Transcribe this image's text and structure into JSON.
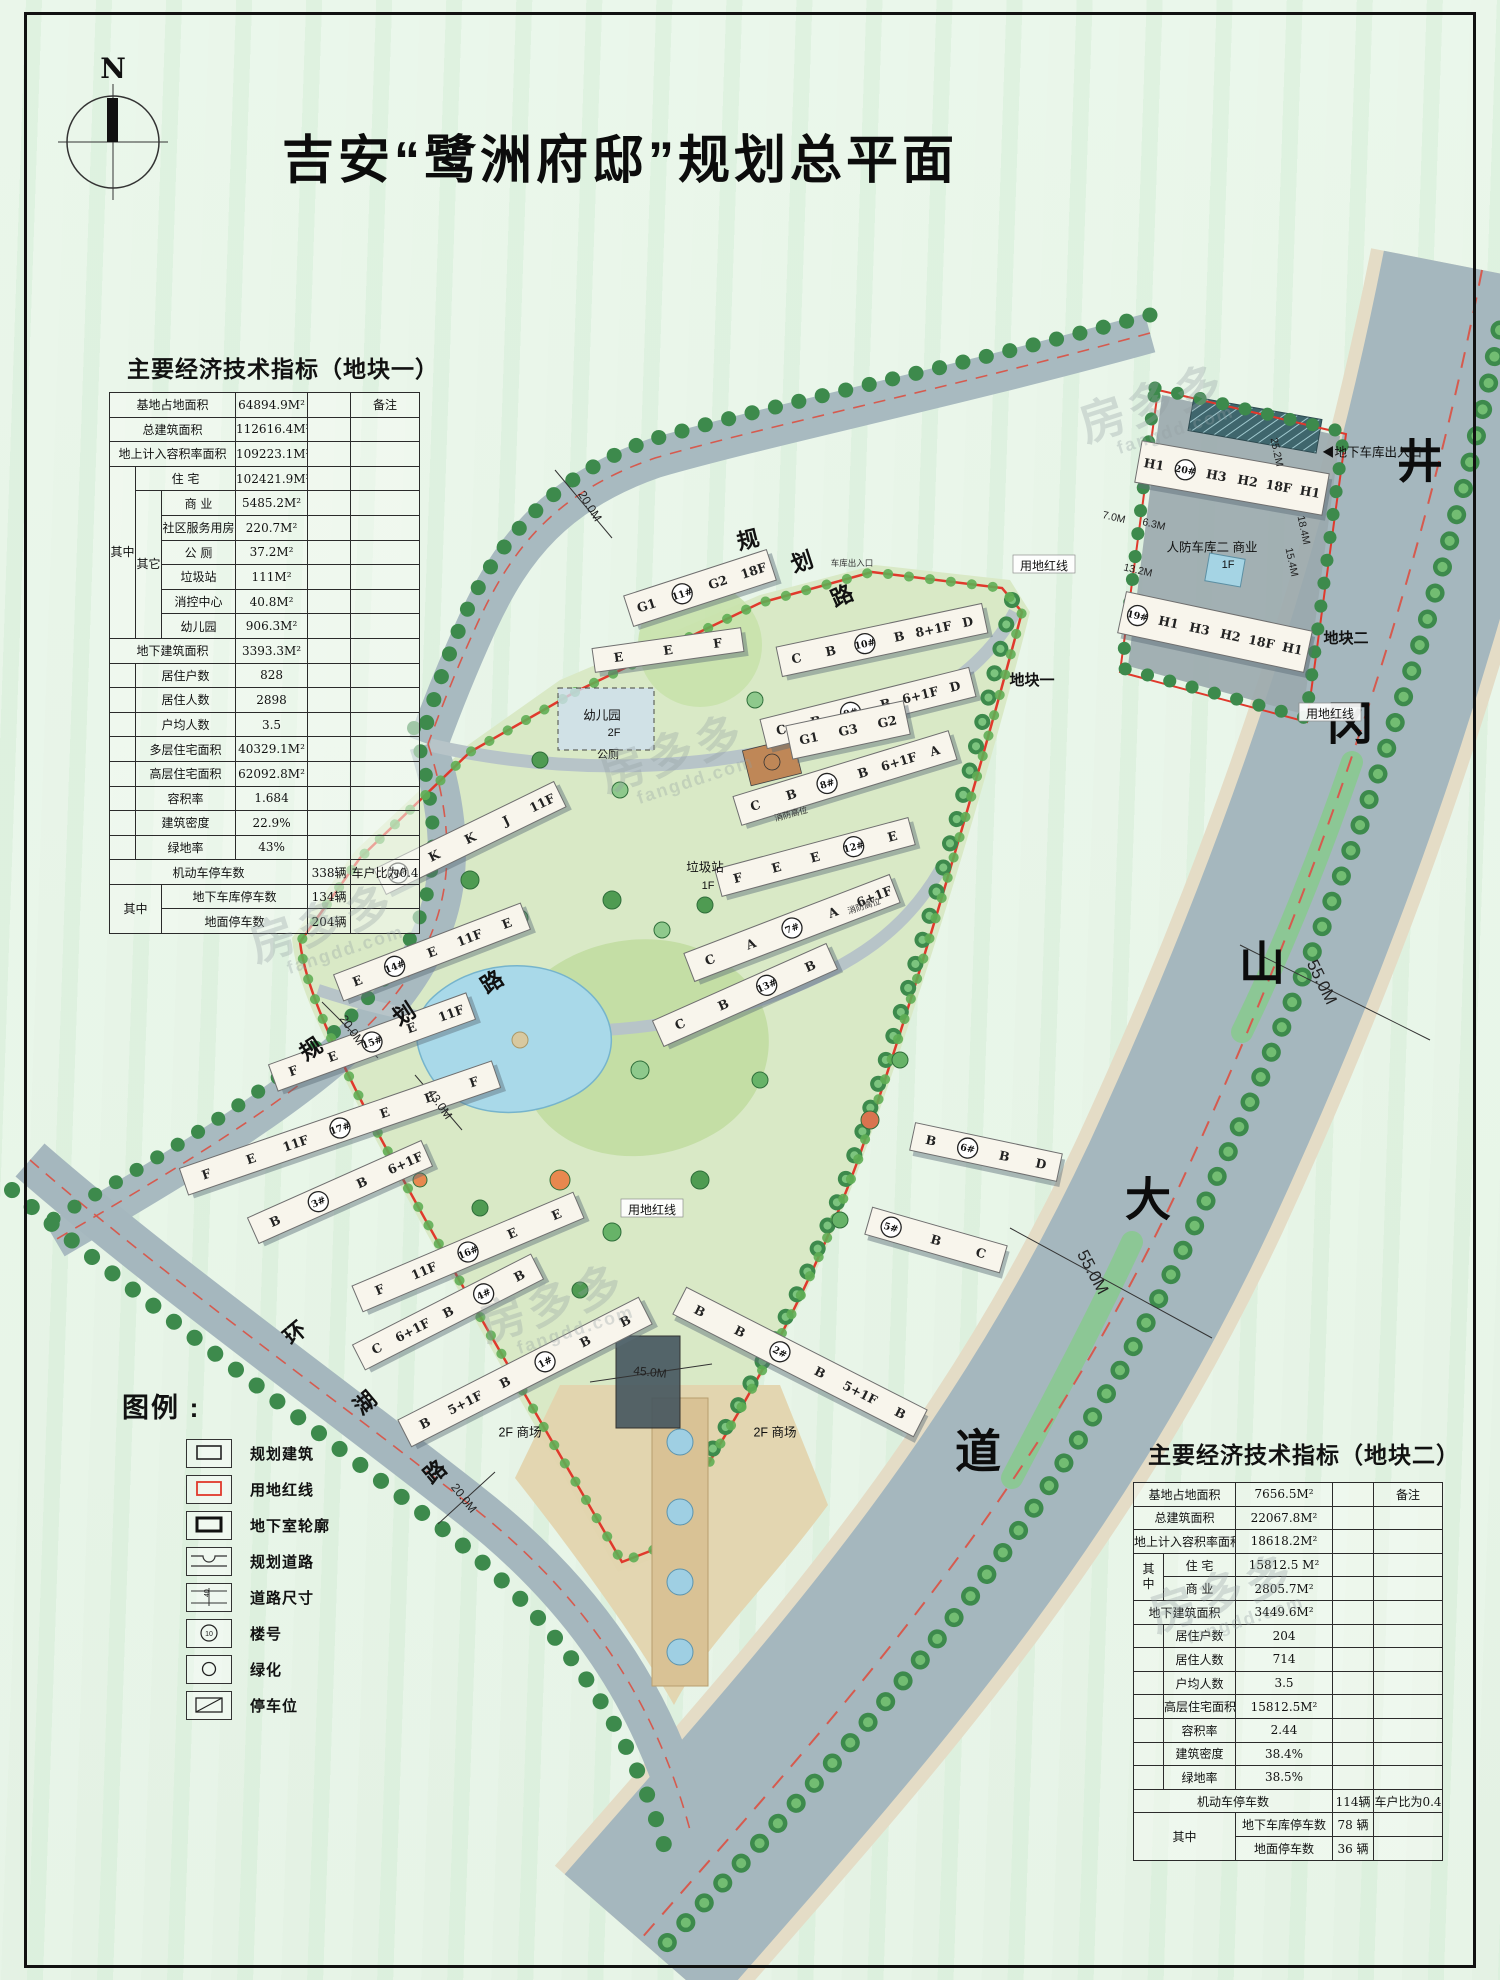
{
  "page": {
    "title": "吉安“鹭洲府邸”规划总平面",
    "north_label": "N"
  },
  "table1": {
    "title": "主要经济技术指标（地块一）",
    "remark_header": "备注",
    "qizhong": "其中",
    "qita": "其它",
    "qizhong2": "其中",
    "r1": {
      "label": "基地占地面积",
      "value": "64894.9M²"
    },
    "r2": {
      "label": "总建筑面积",
      "value": "112616.4M²"
    },
    "r3": {
      "label": "地上计入容积率面积",
      "value": "109223.1M²"
    },
    "r4": {
      "label": "住 宅",
      "value": "102421.9M²"
    },
    "r5": {
      "label": "商 业",
      "value": "5485.2M²"
    },
    "r6": {
      "label": "社区服务用房",
      "value": "220.7M²"
    },
    "r7": {
      "label": "公 厕",
      "value": "37.2M²"
    },
    "r8": {
      "label": "垃圾站",
      "value": "111M²"
    },
    "r9": {
      "label": "消控中心",
      "value": "40.8M²"
    },
    "r10": {
      "label": "幼儿园",
      "value": "906.3M²"
    },
    "r11": {
      "label": "地下建筑面积",
      "value": "3393.3M²"
    },
    "r12": {
      "label": "居住户数",
      "value": "828"
    },
    "r13": {
      "label": "居住人数",
      "value": "2898"
    },
    "r14": {
      "label": "户均人数",
      "value": "3.5"
    },
    "r15": {
      "label": "多层住宅面积",
      "value": "40329.1M²"
    },
    "r16": {
      "label": "高层住宅面积",
      "value": "62092.8M²"
    },
    "r17": {
      "label": "容积率",
      "value": "1.684"
    },
    "r18": {
      "label": "建筑密度",
      "value": "22.9%"
    },
    "r19": {
      "label": "绿地率",
      "value": "43%"
    },
    "r20": {
      "label": "机动车停车数",
      "value": "338辆",
      "remark": "车户比为0.4"
    },
    "r21": {
      "label": "地下车库停车数",
      "value": "134辆"
    },
    "r22": {
      "label": "地面停车数",
      "value": "204辆"
    }
  },
  "table2": {
    "title": "主要经济技术指标（地块二）",
    "remark_header": "备注",
    "qizhong": "其\n中",
    "qizhong2": "其中",
    "r1": {
      "label": "基地占地面积",
      "value": "7656.5M²"
    },
    "r2": {
      "label": "总建筑面积",
      "value": "22067.8M²"
    },
    "r3": {
      "label": "地上计入容积率面积",
      "value": "18618.2M²"
    },
    "r4": {
      "label": "住 宅",
      "value": "15812.5 M²"
    },
    "r5": {
      "label": "商 业",
      "value": "2805.7M²"
    },
    "r6": {
      "label": "地下建筑面积",
      "value": "3449.6M²"
    },
    "r7": {
      "label": "居住户数",
      "value": "204"
    },
    "r8": {
      "label": "居住人数",
      "value": "714"
    },
    "r9": {
      "label": "户均人数",
      "value": "3.5"
    },
    "r10": {
      "label": "高层住宅面积",
      "value": "15812.5M²"
    },
    "r11": {
      "label": "容积率",
      "value": "2.44"
    },
    "r12": {
      "label": "建筑密度",
      "value": "38.4%"
    },
    "r13": {
      "label": "绿地率",
      "value": "38.5%"
    },
    "r14": {
      "label": "机动车停车数",
      "value": "114辆",
      "remark": "车户比为0.4"
    },
    "r15": {
      "label": "地下车库停车数",
      "value": "78 辆"
    },
    "r16": {
      "label": "地面停车数",
      "value": "36 辆"
    }
  },
  "legend": {
    "title": "图例 :",
    "items": [
      {
        "label": "规划建筑"
      },
      {
        "label": "用地红线"
      },
      {
        "label": "地下室轮廓"
      },
      {
        "label": "规划道路"
      },
      {
        "label": "道路尺寸",
        "symbol_text": "40"
      },
      {
        "label": "楼号",
        "symbol_text": "10"
      },
      {
        "label": "绿化"
      },
      {
        "label": "停车位"
      }
    ]
  },
  "watermark": {
    "brand": "房多多",
    "domain": "fangdd.com",
    "positions": [
      {
        "x": 1080,
        "y": 380
      },
      {
        "x": 600,
        "y": 730
      },
      {
        "x": 480,
        "y": 1280
      },
      {
        "x": 1150,
        "y": 1570
      },
      {
        "x": 250,
        "y": 900
      }
    ]
  },
  "map": {
    "colors": {
      "road": "#a5b7be",
      "site": "#d9e9c6",
      "red_line": "#e0392c",
      "water": "#a9d9e9",
      "median": "#8cc795"
    },
    "labels": [
      {
        "t": "井",
        "x": 1420,
        "y": 462,
        "r": 0,
        "c": "ave"
      },
      {
        "t": "冈",
        "x": 1350,
        "y": 724,
        "r": 0,
        "c": "ave"
      },
      {
        "t": "山",
        "x": 1262,
        "y": 964,
        "r": 0,
        "c": "ave"
      },
      {
        "t": "大",
        "x": 1148,
        "y": 1200,
        "r": 0,
        "c": "ave"
      },
      {
        "t": "道",
        "x": 978,
        "y": 1452,
        "r": 0,
        "c": "ave"
      },
      {
        "t": "规",
        "x": 748,
        "y": 540,
        "r": -14,
        "c": "road"
      },
      {
        "t": "划",
        "x": 802,
        "y": 562,
        "r": -18,
        "c": "road"
      },
      {
        "t": "路",
        "x": 842,
        "y": 596,
        "r": -24,
        "c": "road"
      },
      {
        "t": "20.0M",
        "x": 590,
        "y": 506,
        "r": 58,
        "c": "dim"
      },
      {
        "t": "规",
        "x": 311,
        "y": 1049,
        "r": -33,
        "c": "road"
      },
      {
        "t": "划",
        "x": 404,
        "y": 1014,
        "r": -33,
        "c": "road"
      },
      {
        "t": "路",
        "x": 492,
        "y": 982,
        "r": -33,
        "c": "road"
      },
      {
        "t": "20.0M",
        "x": 352,
        "y": 1030,
        "r": 55,
        "c": "dim"
      },
      {
        "t": "环",
        "x": 295,
        "y": 1333,
        "r": -40,
        "c": "road"
      },
      {
        "t": "湖",
        "x": 365,
        "y": 1403,
        "r": -40,
        "c": "road"
      },
      {
        "t": "路",
        "x": 435,
        "y": 1472,
        "r": -40,
        "c": "road"
      },
      {
        "t": "20.0M",
        "x": 464,
        "y": 1498,
        "r": 52,
        "c": "dim"
      },
      {
        "t": "55.0M",
        "x": 1093,
        "y": 1272,
        "r": 62,
        "c": "dim-lg"
      },
      {
        "t": "55.0M",
        "x": 1322,
        "y": 982,
        "r": 64,
        "c": "dim-lg"
      },
      {
        "t": "45.0M",
        "x": 650,
        "y": 1372,
        "r": 6,
        "c": "dim"
      },
      {
        "t": "43.0M",
        "x": 440,
        "y": 1104,
        "r": 55,
        "c": "dim"
      },
      {
        "t": "7.0M",
        "x": 1114,
        "y": 517,
        "r": 13,
        "c": "dim-s"
      },
      {
        "t": "6.3M",
        "x": 1154,
        "y": 524,
        "r": 13,
        "c": "dim-s"
      },
      {
        "t": "13.2M",
        "x": 1138,
        "y": 570,
        "r": 13,
        "c": "dim-s"
      },
      {
        "t": "25.2M",
        "x": 1277,
        "y": 452,
        "r": 78,
        "c": "dim-s"
      },
      {
        "t": "18.4M",
        "x": 1304,
        "y": 530,
        "r": 78,
        "c": "dim-s"
      },
      {
        "t": "15.4M",
        "x": 1292,
        "y": 562,
        "r": 78,
        "c": "dim-s"
      },
      {
        "t": "地块一",
        "x": 1032,
        "y": 680,
        "r": 0,
        "c": "note-lg"
      },
      {
        "t": "地块二",
        "x": 1346,
        "y": 638,
        "r": 0,
        "c": "note-lg"
      },
      {
        "t": "用地红线",
        "x": 1044,
        "y": 566,
        "r": 0,
        "c": "boxed"
      },
      {
        "t": "用地红线",
        "x": 1330,
        "y": 714,
        "r": 0,
        "c": "boxed"
      },
      {
        "t": "用地红线",
        "x": 652,
        "y": 1210,
        "r": 0,
        "c": "boxed"
      },
      {
        "t": "人防车库二  商业",
        "x": 1212,
        "y": 547,
        "r": 0,
        "c": "note"
      },
      {
        "t": "1F",
        "x": 1228,
        "y": 564,
        "r": 0,
        "c": "note-s"
      },
      {
        "t": "◀地下车库出入口",
        "x": 1372,
        "y": 452,
        "r": 0,
        "c": "note"
      },
      {
        "t": "车库出入口",
        "x": 852,
        "y": 563,
        "r": 0,
        "c": "tiny"
      },
      {
        "t": "幼儿园",
        "x": 602,
        "y": 715,
        "r": 0,
        "c": "note"
      },
      {
        "t": "2F",
        "x": 614,
        "y": 732,
        "r": 0,
        "c": "note-s"
      },
      {
        "t": "公厕",
        "x": 608,
        "y": 754,
        "r": 0,
        "c": "note-s"
      },
      {
        "t": "垃圾站",
        "x": 705,
        "y": 867,
        "r": 0,
        "c": "note"
      },
      {
        "t": "1F",
        "x": 708,
        "y": 885,
        "r": 0,
        "c": "note-s"
      },
      {
        "t": "2F  商场",
        "x": 520,
        "y": 1432,
        "r": 0,
        "c": "note"
      },
      {
        "t": "2F  商场",
        "x": 775,
        "y": 1432,
        "r": 0,
        "c": "note"
      },
      {
        "t": "消防高位",
        "x": 791,
        "y": 814,
        "r": -15,
        "c": "tiny"
      },
      {
        "t": "消防高位",
        "x": 864,
        "y": 906,
        "r": -18,
        "c": "tiny"
      }
    ],
    "buildings": [
      {
        "x": 525,
        "y": 1372,
        "w": 270,
        "h": 30,
        "r": -27,
        "items": [
          "B",
          "5+1F",
          "B",
          "@1#",
          "B",
          "B"
        ]
      },
      {
        "x": 800,
        "y": 1362,
        "w": 270,
        "h": 30,
        "r": 27,
        "items": [
          "B",
          "B",
          "@2#",
          "B",
          "5+1F",
          "B"
        ]
      },
      {
        "x": 340,
        "y": 1192,
        "w": 190,
        "h": 28,
        "r": -24,
        "items": [
          "B",
          "@3#",
          "B",
          "6+1F"
        ]
      },
      {
        "x": 448,
        "y": 1312,
        "w": 200,
        "h": 28,
        "r": -27,
        "items": [
          "C",
          "6+1F",
          "B",
          "@4#",
          "B"
        ]
      },
      {
        "x": 936,
        "y": 1240,
        "w": 140,
        "h": 28,
        "r": 16,
        "items": [
          "@5#",
          "B",
          "C"
        ]
      },
      {
        "x": 986,
        "y": 1152,
        "w": 150,
        "h": 28,
        "r": 12,
        "items": [
          "B",
          "@6#",
          "B",
          "D"
        ]
      },
      {
        "x": 792,
        "y": 928,
        "w": 220,
        "h": 30,
        "r": -21,
        "items": [
          "C",
          "A",
          "@7#",
          "A",
          "6+1F"
        ]
      },
      {
        "x": 845,
        "y": 778,
        "w": 225,
        "h": 30,
        "r": -17,
        "items": [
          "C",
          "B",
          "@8#",
          "B",
          "6+1F",
          "A"
        ]
      },
      {
        "x": 868,
        "y": 708,
        "w": 215,
        "h": 30,
        "r": -14,
        "items": [
          "C",
          "B",
          "@9#",
          "B",
          "6+1F",
          "D"
        ]
      },
      {
        "x": 882,
        "y": 640,
        "w": 210,
        "h": 30,
        "r": -12,
        "items": [
          "C",
          "B",
          "@10#",
          "B",
          "8+1F",
          "D"
        ]
      },
      {
        "x": 700,
        "y": 588,
        "w": 150,
        "h": 32,
        "r": -18,
        "items": [
          "G1",
          "@11#",
          "G2",
          "18F"
        ]
      },
      {
        "x": 848,
        "y": 730,
        "w": 120,
        "h": 34,
        "r": -12,
        "items": [
          "G1",
          "G3",
          "G2"
        ]
      },
      {
        "x": 668,
        "y": 650,
        "w": 150,
        "h": 24,
        "r": -8,
        "items": [
          "E",
          "E",
          "F"
        ]
      },
      {
        "x": 815,
        "y": 857,
        "w": 200,
        "h": 28,
        "r": -15,
        "items": [
          "F",
          "E",
          "E",
          "@12#",
          "E"
        ]
      },
      {
        "x": 745,
        "y": 995,
        "w": 190,
        "h": 28,
        "r": -24,
        "items": [
          "C",
          "B",
          "@13#",
          "B"
        ]
      },
      {
        "x": 432,
        "y": 952,
        "w": 200,
        "h": 28,
        "r": -21,
        "items": [
          "E",
          "@14#",
          "E",
          "11F",
          "E"
        ]
      },
      {
        "x": 372,
        "y": 1042,
        "w": 210,
        "h": 28,
        "r": -20,
        "items": [
          "F",
          "E",
          "@15#",
          "E",
          "11F"
        ]
      },
      {
        "x": 468,
        "y": 1252,
        "w": 240,
        "h": 28,
        "r": -23,
        "items": [
          "F",
          "11F",
          "@16#",
          "E",
          "E"
        ]
      },
      {
        "x": 340,
        "y": 1128,
        "w": 330,
        "h": 28,
        "r": -19,
        "items": [
          "F",
          "E",
          "11F",
          "@17#",
          "E",
          "E",
          "F"
        ]
      },
      {
        "x": 470,
        "y": 838,
        "w": 200,
        "h": 28,
        "r": -26,
        "items": [
          "@18#",
          "K",
          "K",
          "J",
          "11F"
        ]
      },
      {
        "x": 1215,
        "y": 632,
        "w": 190,
        "h": 42,
        "r": 12,
        "items": [
          "@19#",
          "H1",
          "H3",
          "H2",
          "18F",
          "H1"
        ]
      },
      {
        "x": 1232,
        "y": 478,
        "w": 190,
        "h": 42,
        "r": 10,
        "items": [
          "H1",
          "@20#",
          "H3",
          "H2",
          "18F",
          "H1"
        ]
      }
    ]
  }
}
